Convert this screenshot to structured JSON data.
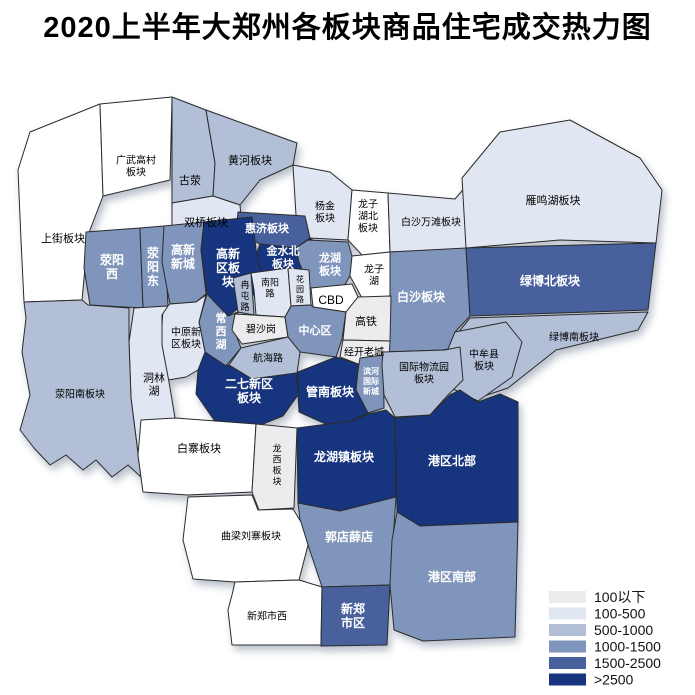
{
  "title": "2020上半年大郑州各板块商品住宅成交热力图",
  "legend": {
    "items": [
      {
        "label": "100以下",
        "color": "#ececee"
      },
      {
        "label": "100-500",
        "color": "#e1e7f2"
      },
      {
        "label": "500-1000",
        "color": "#b2bfd7"
      },
      {
        "label": "1000-1500",
        "color": "#8095bb"
      },
      {
        "label": "1500-2500",
        "color": "#48619c"
      },
      {
        "label": ">2500",
        "color": "#16357e"
      }
    ]
  },
  "map": {
    "border_color": "#2b2b2b",
    "palette": {
      "white": "#ffffff",
      "l1": "#ececee",
      "l2": "#e1e7f2",
      "l3": "#b2bfd7",
      "l4": "#8095bb",
      "l5": "#48619c",
      "l6": "#16357e"
    },
    "light_keys": [
      "l4",
      "l5",
      "l6"
    ],
    "regions": [
      {
        "id": "shangjie",
        "lines": [
          "上街板块"
        ],
        "key": "white",
        "fs": 11,
        "lx": 63,
        "ly": 238,
        "pts": "100,104 30,132 18,170 21,240 24,302 82,300 88,235 103,196"
      },
      {
        "id": "guangwugaocun",
        "lines": [
          "广武高村",
          "板块"
        ],
        "key": "white",
        "fs": 10,
        "lx": 136,
        "ly": 166,
        "pts": "100,104 172,97 170,180 103,196"
      },
      {
        "id": "guying",
        "lines": [
          "古荥"
        ],
        "key": "l3",
        "fs": 11,
        "lx": 190,
        "ly": 180,
        "pts": "172,97 206,110 215,163 213,196 172,203"
      },
      {
        "id": "huanghe",
        "lines": [
          "黄河板块"
        ],
        "key": "l3",
        "fs": 11,
        "lx": 250,
        "ly": 160,
        "pts": "206,110 297,143 293,165 260,180 240,205 213,196 215,163"
      },
      {
        "id": "shuangqiao",
        "lines": [
          "双桥板块"
        ],
        "key": "l2",
        "fs": 11,
        "lx": 206,
        "ly": 222,
        "pts": "172,203 213,196 240,205 242,228 205,235 172,230"
      },
      {
        "id": "yangjin",
        "lines": [
          "杨金",
          "板块"
        ],
        "key": "l2",
        "fs": 10,
        "lx": 325,
        "ly": 212,
        "pts": "293,165 330,172 352,190 348,240 310,238 296,215"
      },
      {
        "id": "longzihubei",
        "lines": [
          "龙子",
          "湖北",
          "板块"
        ],
        "key": "white",
        "fs": 10,
        "lx": 368,
        "ly": 216,
        "pts": "352,190 388,193 390,252 362,255 348,240"
      },
      {
        "id": "baishawantan",
        "lines": [
          "白沙万滩板块"
        ],
        "key": "l2",
        "fs": 10,
        "lx": 431,
        "ly": 222,
        "pts": "388,193 455,199 468,184 476,205 478,248 390,252"
      },
      {
        "id": "yanminghu",
        "lines": [
          "雁鸣湖板块"
        ],
        "key": "l2",
        "fs": 11,
        "lx": 553,
        "ly": 200,
        "pts": "462,178 500,132 570,120 640,158 662,190 656,243 560,240 466,248"
      },
      {
        "id": "huiji",
        "lines": [
          "惠济板块"
        ],
        "key": "l5",
        "fs": 11,
        "lx": 267,
        "ly": 228,
        "pts": "238,212 305,216 310,238 296,248 260,244 236,232"
      },
      {
        "id": "jinshuibei",
        "lines": [
          "金水北",
          "板块"
        ],
        "key": "l6",
        "fs": 11,
        "lx": 283,
        "ly": 257,
        "pts": "260,244 296,248 310,238 328,252 322,277 262,280 254,260"
      },
      {
        "id": "xingyangxi",
        "lines": [
          "荥阳",
          "西"
        ],
        "key": "l4",
        "fs": 12,
        "lx": 112,
        "ly": 267,
        "pts": "86,232 140,228 143,308 90,305 84,268"
      },
      {
        "id": "xingyangdong",
        "lines": [
          "荥",
          "阳",
          "东"
        ],
        "key": "l4",
        "fs": 12,
        "lx": 153,
        "ly": 267,
        "pts": "140,228 164,226 168,306 143,308"
      },
      {
        "id": "gaoxinxincheng",
        "lines": [
          "高新",
          "新城"
        ],
        "key": "l4",
        "fs": 12,
        "lx": 183,
        "ly": 257,
        "pts": "164,226 204,222 201,250 206,294 196,302 170,304 162,262"
      },
      {
        "id": "gaoxinqu",
        "lines": [
          "高新",
          "区板",
          "块"
        ],
        "key": "l6",
        "fs": 12,
        "lx": 228,
        "ly": 268,
        "pts": "204,222 252,217 257,257 263,278 251,299 228,316 207,294 201,250"
      },
      {
        "id": "longhu",
        "lines": [
          "龙湖",
          "板块"
        ],
        "key": "l4",
        "fs": 11,
        "lx": 330,
        "ly": 264,
        "pts": "308,240 348,242 352,256 350,276 344,286 310,288 299,262 296,248"
      },
      {
        "id": "longzihu",
        "lines": [
          "龙子",
          "湖"
        ],
        "key": "white",
        "fs": 10,
        "lx": 374,
        "ly": 275,
        "pts": "352,256 390,252 392,296 362,298 350,276"
      },
      {
        "id": "baisha",
        "lines": [
          "白沙板块"
        ],
        "key": "l4",
        "fs": 12,
        "lx": 421,
        "ly": 297,
        "pts": "390,252 466,248 470,316 455,332 460,347 443,350 384,352 390,296"
      },
      {
        "id": "lvbobei",
        "lines": [
          "绿博北板块"
        ],
        "key": "l5",
        "fs": 12,
        "lx": 550,
        "ly": 281,
        "pts": "466,248 656,243 648,310 470,316"
      },
      {
        "id": "lvbonan",
        "lines": [
          "绿博南板块"
        ],
        "key": "l3",
        "fs": 10,
        "lx": 574,
        "ly": 337,
        "pts": "470,318 648,312 638,330 556,350 508,388 472,400 450,372 452,340"
      },
      {
        "id": "zhongmouxian",
        "lines": [
          "中牟县",
          "板块"
        ],
        "key": "l3",
        "fs": 10,
        "lx": 484,
        "ly": 360,
        "pts": "455,332 506,322 522,342 512,377 478,401 451,388 443,361"
      },
      {
        "id": "rantunlu",
        "lines": [
          "冉",
          "屯",
          "路"
        ],
        "key": "l3",
        "fs": 9,
        "lx": 245,
        "ly": 296,
        "pts": "233,278 251,273 254,315 238,312"
      },
      {
        "id": "nanyanglu",
        "lines": [
          "南阳",
          "路"
        ],
        "key": "l2",
        "fs": 9,
        "lx": 270,
        "ly": 288,
        "pts": "251,273 288,268 291,306 285,317 256,315 254,290"
      },
      {
        "id": "huayuanlu",
        "lines": [
          "花",
          "园",
          "路"
        ],
        "key": "l2",
        "fs": 8,
        "lx": 300,
        "ly": 289,
        "pts": "288,268 309,270 311,305 291,306"
      },
      {
        "id": "cbd",
        "lines": [
          "CBD"
        ],
        "key": "white",
        "fs": 12,
        "lx": 331,
        "ly": 300,
        "pts": "311,288 352,284 358,297 346,312 313,307"
      },
      {
        "id": "changxihu",
        "lines": [
          "常",
          "西",
          "湖"
        ],
        "key": "l4",
        "fs": 11,
        "lx": 221,
        "ly": 331,
        "pts": "207,294 228,316 238,312 235,332 241,348 226,366 205,352 199,322"
      },
      {
        "id": "bishagang",
        "lines": [
          "碧沙岗"
        ],
        "key": "l1",
        "fs": 10,
        "lx": 261,
        "ly": 329,
        "pts": "235,314 285,317 288,337 242,344 232,330"
      },
      {
        "id": "zhongxinqu",
        "lines": [
          "中心区"
        ],
        "key": "l4",
        "fs": 11,
        "lx": 315,
        "ly": 330,
        "pts": "285,317 291,306 311,305 313,307 346,312 342,339 336,357 300,352 288,337"
      },
      {
        "id": "gaotie",
        "lines": [
          "高铁"
        ],
        "key": "l1",
        "fs": 11,
        "lx": 366,
        "ly": 321,
        "pts": "358,297 391,296 390,341 343,340 346,312"
      },
      {
        "id": "jingkailaocheng",
        "lines": [
          "经开老城"
        ],
        "key": "l1",
        "fs": 10,
        "lx": 364,
        "ly": 352,
        "pts": "343,340 390,341 389,362 358,364 340,357"
      },
      {
        "id": "hanghailu",
        "lines": [
          "航海路"
        ],
        "key": "l3",
        "fs": 10,
        "lx": 268,
        "ly": 358,
        "pts": "241,348 288,337 300,352 297,373 252,379 229,365"
      },
      {
        "id": "binhe",
        "lines": [
          "滨河",
          "国际",
          "新城"
        ],
        "key": "l4",
        "fs": 8,
        "lx": 371,
        "ly": 381,
        "pts": "360,358 383,355 384,408 368,413 356,390 358,370"
      },
      {
        "id": "guojiwuliuyuan",
        "lines": [
          "国际物流园",
          "板块"
        ],
        "key": "l3",
        "fs": 10,
        "lx": 424,
        "ly": 373,
        "pts": "383,352 445,350 460,347 463,380 448,395 430,415 395,417 384,395 382,365"
      },
      {
        "id": "erqixinqu",
        "lines": [
          "二七新区",
          "板块"
        ],
        "key": "l6",
        "fs": 12,
        "lx": 249,
        "ly": 391,
        "pts": "205,352 226,366 229,365 252,379 297,373 298,395 283,416 253,428 214,420 196,394 198,370"
      },
      {
        "id": "guannan",
        "lines": [
          "管南板块"
        ],
        "key": "l6",
        "fs": 12,
        "lx": 330,
        "ly": 392,
        "pts": "298,372 336,357 358,364 356,390 368,413 352,421 328,425 299,412 298,395"
      },
      {
        "id": "zhongyuanxinqu",
        "lines": [
          "中原新",
          "区板块"
        ],
        "key": "l2",
        "fs": 10,
        "lx": 186,
        "ly": 338,
        "pts": "170,304 196,302 206,295 199,322 205,352 198,370 186,377 168,380 161,340 163,310"
      },
      {
        "id": "donglinhu",
        "lines": [
          "洞林",
          "湖"
        ],
        "key": "l2",
        "fs": 11,
        "lx": 154,
        "ly": 384,
        "pts": "134,308 168,306 162,315 162,345 169,382 175,418 167,470 141,477 131,398 129,342"
      },
      {
        "id": "xingyangnan",
        "lines": [
          "荥阳南板块"
        ],
        "key": "l3",
        "fs": 10,
        "lx": 80,
        "ly": 394,
        "pts": "24,302 82,300 88,305 129,308 129,342 131,398 141,477 128,465 112,477 96,460 83,470 66,455 50,465 34,448 20,430 30,395 22,352 26,318"
      },
      {
        "id": "baizhai",
        "lines": [
          "白寨板块"
        ],
        "key": "white",
        "fs": 11,
        "lx": 199,
        "ly": 448,
        "pts": "141,420 175,418 256,424 252,492 188,495 143,492 138,455"
      },
      {
        "id": "longxi",
        "lines": [
          "龙",
          "西",
          "板",
          "块"
        ],
        "key": "l1",
        "fs": 9,
        "lx": 277,
        "ly": 465,
        "pts": "256,424 297,428 294,508 259,510 252,492"
      },
      {
        "id": "longhuzhen",
        "lines": [
          "龙湖镇板块"
        ],
        "key": "l6",
        "fs": 12,
        "lx": 344,
        "ly": 457,
        "pts": "297,428 352,421 368,414 386,410 395,418 396,497 340,511 298,503"
      },
      {
        "id": "gangqubeibu",
        "lines": [
          "港区北部"
        ],
        "key": "l6",
        "fs": 12,
        "lx": 452,
        "ly": 461,
        "pts": "395,418 430,415 450,395 460,390 478,402 500,394 518,402 518,522 420,526 397,512"
      },
      {
        "id": "guodianxuedian",
        "lines": [
          "郭店薛店"
        ],
        "key": "l4",
        "fs": 12,
        "lx": 349,
        "ly": 537,
        "pts": "298,503 340,511 396,497 390,585 322,587 308,545 300,520"
      },
      {
        "id": "gangqunanbu",
        "lines": [
          "港区南部"
        ],
        "key": "l4",
        "fs": 12,
        "lx": 452,
        "ly": 577,
        "pts": "397,512 420,526 518,522 515,637 423,641 394,630 390,585 392,540"
      },
      {
        "id": "qumeliuzhai",
        "lines": [
          "曲梁刘寨板块"
        ],
        "key": "white",
        "fs": 10,
        "lx": 251,
        "ly": 536,
        "pts": "188,497 252,495 258,510 293,509 301,522 308,545 299,580 235,582 193,579 183,540"
      },
      {
        "id": "xinzhengshixi",
        "lines": [
          "新郑市西"
        ],
        "key": "white",
        "fs": 10,
        "lx": 267,
        "ly": 616,
        "pts": "235,582 299,580 322,587 321,645 232,645 228,610 232,595"
      },
      {
        "id": "xinzhengshiqu",
        "lines": [
          "新郑",
          "市区"
        ],
        "key": "l5",
        "fs": 12,
        "lx": 353,
        "ly": 616,
        "pts": "322,587 390,585 387,645 321,646"
      }
    ]
  }
}
